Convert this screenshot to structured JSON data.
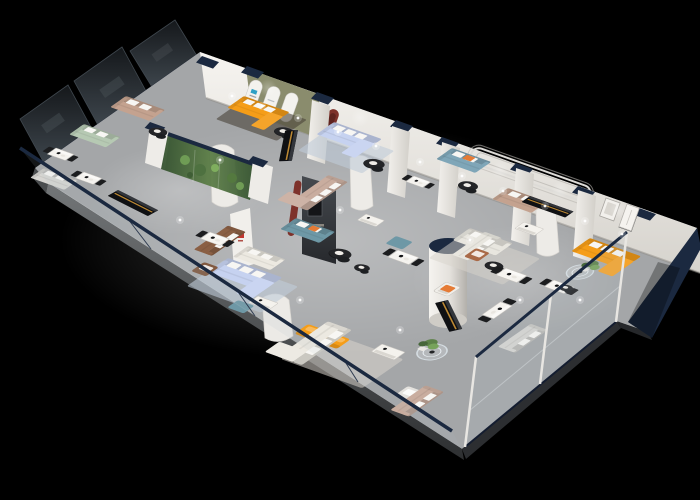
{
  "scene": {
    "type": "3d-isometric-floorplan-render",
    "subject": "furniture showroom interior cutaway viewed from above at an angle on a black background",
    "background": "#000000",
    "palette": {
      "floor": "#a4a6a8",
      "floor_light": "#c9cbcc",
      "slab_edge": "#55585a",
      "wall_white": "#efede9",
      "wall_shade": "#cfccc7",
      "navy": "#1b2940",
      "dark_glass": "#1b2024",
      "glass_tint": "#aebec6",
      "orange": "#f59d18",
      "periwinkle": "#c6d2f0",
      "steel_blue": "#7fa6b8",
      "teal": "#6e98a6",
      "sage": "#b6c9b3",
      "tan": "#c4a28f",
      "blush": "#c9ad9f",
      "brown": "#8a5f44",
      "cream": "#ece9e1",
      "white_sofa": "#e8e6df",
      "grey_sofa": "#d7d6d2",
      "olive": "#8a8c6d",
      "maroon": "#7e322b",
      "plant_green": "#5d8249",
      "rug_blue": "#bfcbd9",
      "rug_cream": "#d8d4cc",
      "rug_brown": "#4a4238",
      "black_furniture": "#141519",
      "amber_glow": "#c68f35",
      "logo_red": "#c23730",
      "logo_blue": "#2ea0c5"
    },
    "elements": {
      "rooms": [
        "dark glazed lounges along back-left wall",
        "display room with three arched niches on olive wall",
        "planted glass terrarium partition",
        "central charcoal feature-wall lounge",
        "open sofa galleries with display dining sets",
        "glass-railed front edge walkway",
        "glass-partitioned dining corner",
        "right-end lounge with orange sectional and framed art"
      ],
      "furniture_counts": {
        "sofas": 17,
        "armchairs": 5,
        "dining_sets": 8,
        "coffee_tables": 9,
        "media_consoles": 4,
        "columns": 8,
        "plants": 3
      }
    }
  }
}
